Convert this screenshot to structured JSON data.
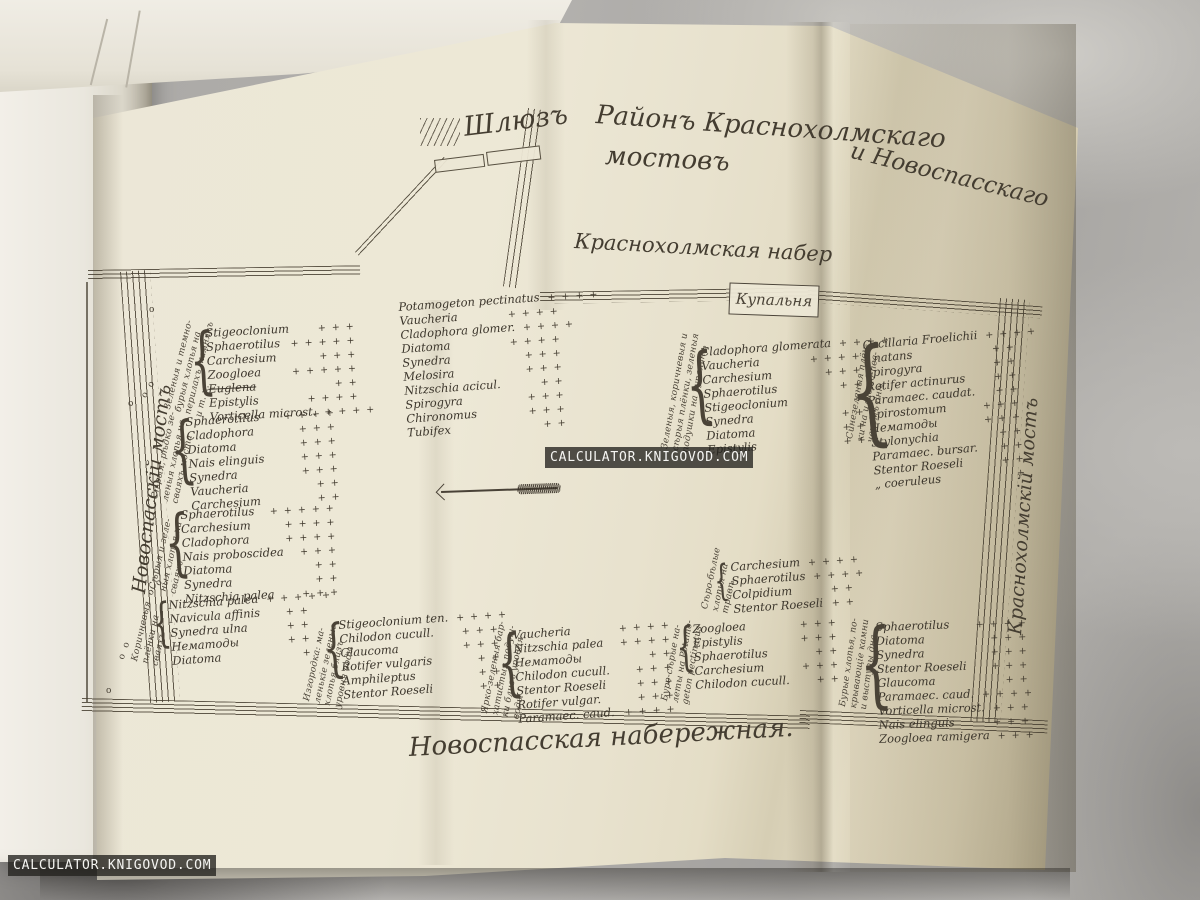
{
  "photo": {
    "watermark_text": "CALCULATOR.KNIGOVOD.COM"
  },
  "map": {
    "brace_glyph": "{",
    "sluice": "Шлюзъ",
    "title_part1": "Районъ Краснохолмскаго",
    "title_part2": "и Новоспасскаго",
    "title_part3": "мостовъ",
    "top_embankment": "Краснохолмская набер",
    "bottom_embankment": "Новоспасская набережная.",
    "left_bridge": "Новоспасскій мостъ",
    "right_bridge": "Краснохолмскій мостъ",
    "bathhouse": "Купальня",
    "groups": [
      {
        "id": "rail-flakes",
        "x": 205,
        "y": 326,
        "w": 150,
        "rot": -3,
        "brace": true,
        "note": {
          "x": 163,
          "y": 408,
          "rot": -76,
          "text": "Зеленыя и темно-\nбурыя хлопья на\nперилахъ, камняхъ\nи т. п."
        },
        "rows": [
          {
            "n": "Stigeoclonium",
            "p": "+ + +"
          },
          {
            "n": "Sphaerotilus",
            "p": "+ + + + +"
          },
          {
            "n": "Carchesium",
            "p": "+ + +"
          },
          {
            "n": "Zoogloea",
            "p": "+ + + + +"
          },
          {
            "n": "Euglena",
            "p": "+ +",
            "strike": true
          },
          {
            "n": "Epistylis",
            "p": "+ + + +"
          },
          {
            "n": "Vorticella microst.",
            "p": "+ + + +"
          }
        ]
      },
      {
        "id": "grey-flakes-piles",
        "x": 185,
        "y": 415,
        "w": 150,
        "rot": -4,
        "brace": true,
        "note": {
          "x": 150,
          "y": 498,
          "rot": -78,
          "text": "Сѣрыя, рѣдко зе-\nленыя хлопья на\nсваяхъ моста"
        },
        "rows": [
          {
            "n": "Sphaerotilus",
            "p": "+ + + +"
          },
          {
            "n": "Cladophora",
            "p": "+ + +"
          },
          {
            "n": "Diatoma",
            "p": "+ + +"
          },
          {
            "n": "Nais elinguis",
            "p": "+ + +"
          },
          {
            "n": "Synedra",
            "p": "+ + +"
          },
          {
            "n": "Vaucheria",
            "p": "+ +"
          },
          {
            "n": "Carchesium",
            "p": "+ +"
          }
        ]
      },
      {
        "id": "grey-green-piles",
        "x": 180,
        "y": 508,
        "w": 155,
        "rot": -3,
        "brace": true,
        "note": {
          "x": 148,
          "y": 588,
          "rot": -77,
          "text": "Сѣрыя и зеле-\nныя хлопья на\nсваяхъ"
        },
        "rows": [
          {
            "n": "Sphaerotilus",
            "p": "+ + + + +"
          },
          {
            "n": "Carchesium",
            "p": "+ + + +"
          },
          {
            "n": "Cladophora",
            "p": "+ + + +"
          },
          {
            "n": "Nais proboscidea",
            "p": "+ + +"
          },
          {
            "n": "Diatoma",
            "p": "+ +"
          },
          {
            "n": "Synedra",
            "p": "+ +"
          },
          {
            "n": "Nitzschia palea",
            "p": "+ + +"
          }
        ]
      },
      {
        "id": "brown-films-piles",
        "x": 168,
        "y": 598,
        "w": 140,
        "rot": -4,
        "brace": true,
        "note": {
          "x": 130,
          "y": 660,
          "rot": -77,
          "text": "Коричневыя\nплёнки на\nсваяхъ"
        },
        "rows": [
          {
            "n": "Nitzschia palea",
            "p": "+ + + + +"
          },
          {
            "n": "Navicula affinis",
            "p": "+ +"
          },
          {
            "n": "Synedra ulna",
            "p": "+ +"
          },
          {
            "n": "Нематоды",
            "p": "+ +"
          },
          {
            "n": "Diatoma",
            "p": "+"
          }
        ]
      },
      {
        "id": "sluice-channel",
        "x": 398,
        "y": 300,
        "w": 160,
        "rot": -4,
        "brace": false,
        "rows": [
          {
            "n": "Potamogeton pectinatus",
            "p": "+ + + +"
          },
          {
            "n": "Vaucheria",
            "p": "+ + + +"
          },
          {
            "n": "Cladophora glomer.",
            "p": "+ + + +"
          },
          {
            "n": "Diatoma",
            "p": "+ + + +"
          },
          {
            "n": "Synedra",
            "p": "+ + +"
          },
          {
            "n": "Melosira",
            "p": "+ + +"
          },
          {
            "n": "Nitzschia acicul.",
            "p": "+ +"
          },
          {
            "n": "Spirogyra",
            "p": "+ + +"
          },
          {
            "n": "Chironomus",
            "p": "+ + +"
          },
          {
            "n": "Tubifex",
            "p": "+ +"
          }
        ]
      },
      {
        "id": "bathhouse-cushions",
        "x": 700,
        "y": 345,
        "w": 160,
        "rot": -4,
        "brace": true,
        "note": {
          "x": 660,
          "y": 448,
          "rot": -80,
          "text": "Зеленыя, коричневыя и\nсѣрыя плёнки, зеленыя\nподушки на купальнѣ"
        },
        "rows": [
          {
            "n": "Cladophora glomerata",
            "p": "+ + + +"
          },
          {
            "n": "Vaucheria",
            "p": "+ + + +"
          },
          {
            "n": "Carchesium",
            "p": "+ + +"
          },
          {
            "n": "Sphaerotilus",
            "p": "+ +"
          },
          {
            "n": "Stigeoclonium",
            "p": "+"
          },
          {
            "n": "Synedra",
            "p": "+ +"
          },
          {
            "n": "Diatoma",
            "p": "+ +"
          },
          {
            "n": "Epistylis",
            "p": "+ +"
          }
        ]
      },
      {
        "id": "blue-green-bottom",
        "x": 862,
        "y": 338,
        "w": 152,
        "rot": -5,
        "brace": true,
        "note": {
          "x": 845,
          "y": 438,
          "rot": -80,
          "text": "Синезеленыя плён-\nки на илисто-пес-\nчаномъ днѣ"
        },
        "rows": [
          {
            "n": "Oscillaria Froelichii",
            "p": "+ + + +"
          },
          {
            "n": "„  natans",
            "p": "+ +"
          },
          {
            "n": "Spirogyra",
            "p": "+ +"
          },
          {
            "n": "Rotifer actinurus",
            "p": "+ +"
          },
          {
            "n": "Paramaec. caudat.",
            "p": "+ +"
          },
          {
            "n": "Spirostomum",
            "p": "+ + +"
          },
          {
            "n": "Нематоды",
            "p": "+ + +"
          },
          {
            "n": "Stylonychia",
            "p": "+ +"
          },
          {
            "n": "Paramaec. bursar.",
            "p": "+ +"
          },
          {
            "n": "Stentor Roeseli",
            "p": "+ +"
          },
          {
            "n": "„  coeruleus",
            "p": "+"
          }
        ]
      },
      {
        "id": "grass-flakes",
        "x": 730,
        "y": 560,
        "w": 122,
        "rot": -4,
        "brace": true,
        "note": {
          "x": 700,
          "y": 608,
          "rot": -78,
          "text": "Сѣро-бѣлые\nхлопья на\nтравѣ"
        },
        "rows": [
          {
            "n": "Carchesium",
            "p": "+ + + +"
          },
          {
            "n": "Sphaerotilus",
            "p": "+ + + +"
          },
          {
            "n": "Colpidium",
            "p": "+ +"
          },
          {
            "n": "Stentor Roeseli",
            "p": "+ +"
          }
        ]
      },
      {
        "id": "fence-waterline",
        "x": 338,
        "y": 618,
        "w": 160,
        "rot": -4,
        "brace": true,
        "note": {
          "x": 302,
          "y": 700,
          "rot": -78,
          "text": "Изгородка: ма-\nленькіе зеленые\nхлопья близъ\nуровня воды"
        },
        "rows": [
          {
            "n": "Stigeoclonium ten.",
            "p": "+ + + +"
          },
          {
            "n": "Chilodon cucull.",
            "p": "+ + +"
          },
          {
            "n": "Glaucoma",
            "p": "+ + +"
          },
          {
            "n": "Rotifer vulgaris",
            "p": "+ +"
          },
          {
            "n": "Amphileptus",
            "p": "+ +"
          },
          {
            "n": "Stentor Roeseli",
            "p": "+ +"
          }
        ]
      },
      {
        "id": "velvet-cushions",
        "x": 512,
        "y": 628,
        "w": 158,
        "rot": -4,
        "brace": true,
        "note": {
          "x": 480,
          "y": 712,
          "rot": -79,
          "text": "Ярко-зеленыя бар-\nхатистыя подуш-\nки близъ уровня\nводы"
        },
        "rows": [
          {
            "n": "Vaucheria",
            "p": "+ + + +"
          },
          {
            "n": "Nitzschia palea",
            "p": "+ + + +"
          },
          {
            "n": "Нематоды",
            "p": "+ +"
          },
          {
            "n": "Chilodon cucull.",
            "p": "+ + +"
          },
          {
            "n": "Stentor Roeseli",
            "p": "+ + +"
          },
          {
            "n": "Rotifer vulgar.",
            "p": "+ + +"
          },
          {
            "n": "Paramaec. caud.",
            "p": "+ + + +"
          }
        ]
      },
      {
        "id": "potamogeton-deposits",
        "x": 692,
        "y": 622,
        "w": 145,
        "rot": -3,
        "brace": true,
        "note": {
          "x": 660,
          "y": 700,
          "rot": -80,
          "text": "Буро-сѣрые на-\nлеты на Potamo-\ngeton pectinatus"
        },
        "rows": [
          {
            "n": "Zoogloea",
            "p": "+ + +"
          },
          {
            "n": "Epistylis",
            "p": "+ + +"
          },
          {
            "n": "Sphaerotilus",
            "p": "+ +"
          },
          {
            "n": "Carchesium",
            "p": "+ + +"
          },
          {
            "n": "Chilodon cucull.",
            "p": "+ +"
          }
        ]
      },
      {
        "id": "stones-bottom",
        "x": 875,
        "y": 620,
        "w": 152,
        "rot": -2,
        "brace": true,
        "note": {
          "x": 838,
          "y": 706,
          "rot": -82,
          "text": "Бурые хлопья, по-\nкрывающіе камни\nи выступы дна"
        },
        "rows": [
          {
            "n": "Sphaerotilus",
            "p": "+ + + +"
          },
          {
            "n": "Diatoma",
            "p": "+ + +"
          },
          {
            "n": "Synedra",
            "p": "+ + +"
          },
          {
            "n": "Stentor Roeseli",
            "p": "+ + +"
          },
          {
            "n": "Glaucoma",
            "p": "+ +"
          },
          {
            "n": "Paramaec. caud.",
            "p": "+ + + +"
          },
          {
            "n": "Vorticella microst.",
            "p": "+ + +"
          },
          {
            "n": "Nais elinguis",
            "p": "+ + +"
          },
          {
            "n": "Zoogloea ramigera",
            "p": "+ + +"
          }
        ]
      }
    ],
    "soundings": [
      {
        "x": 149,
        "y": 305,
        "t": "о",
        "rot": 0
      },
      {
        "x": 139,
        "y": 384,
        "t": "о о",
        "rot": -60
      },
      {
        "x": 128,
        "y": 399,
        "t": "о",
        "rot": 0
      },
      {
        "x": 146,
        "y": 582,
        "t": "о о",
        "rot": -50
      },
      {
        "x": 115,
        "y": 645,
        "t": "о о",
        "rot": -70
      },
      {
        "x": 106,
        "y": 686,
        "t": "о",
        "rot": 0
      }
    ]
  }
}
